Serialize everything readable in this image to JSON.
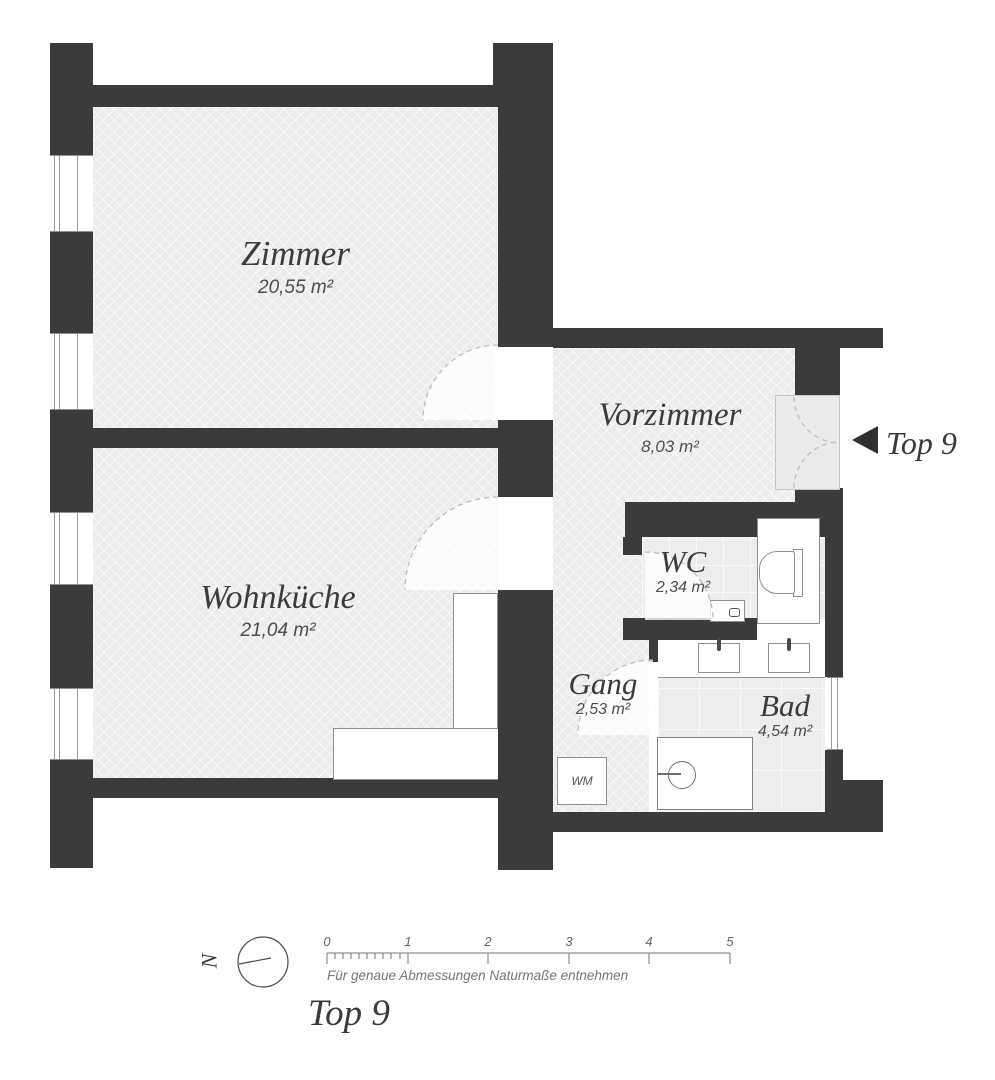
{
  "plan": {
    "rooms": [
      {
        "name": "Zimmer",
        "area": "20,55 m²"
      },
      {
        "name": "Wohnküche",
        "area": "21,04 m²"
      },
      {
        "name": "Vorzimmer",
        "area": "8,03 m²"
      },
      {
        "name": "WC",
        "area": "2,34 m²"
      },
      {
        "name": "Gang",
        "area": "2,53 m²"
      },
      {
        "name": "Bad",
        "area": "4,54 m²"
      }
    ],
    "entrance": {
      "label": "Top 9",
      "arrow_icon": "left-triangle-icon"
    },
    "fixtures": {
      "washing_machine_label": "WM"
    }
  },
  "footer": {
    "compass": {
      "label": "N"
    },
    "scale": {
      "ticks": [
        "0",
        "1",
        "2",
        "3",
        "4",
        "5"
      ],
      "caption": "Für genaue Abmessungen Naturmaße entnehmen"
    },
    "title": "Top 9"
  },
  "colors": {
    "wall": "#3b3b3b",
    "floor": "#ececec",
    "fixture_border": "#8f8f8f",
    "arc_dash": "#bdbdbd",
    "text": "#3c3c3c",
    "muted_text": "#757575"
  }
}
